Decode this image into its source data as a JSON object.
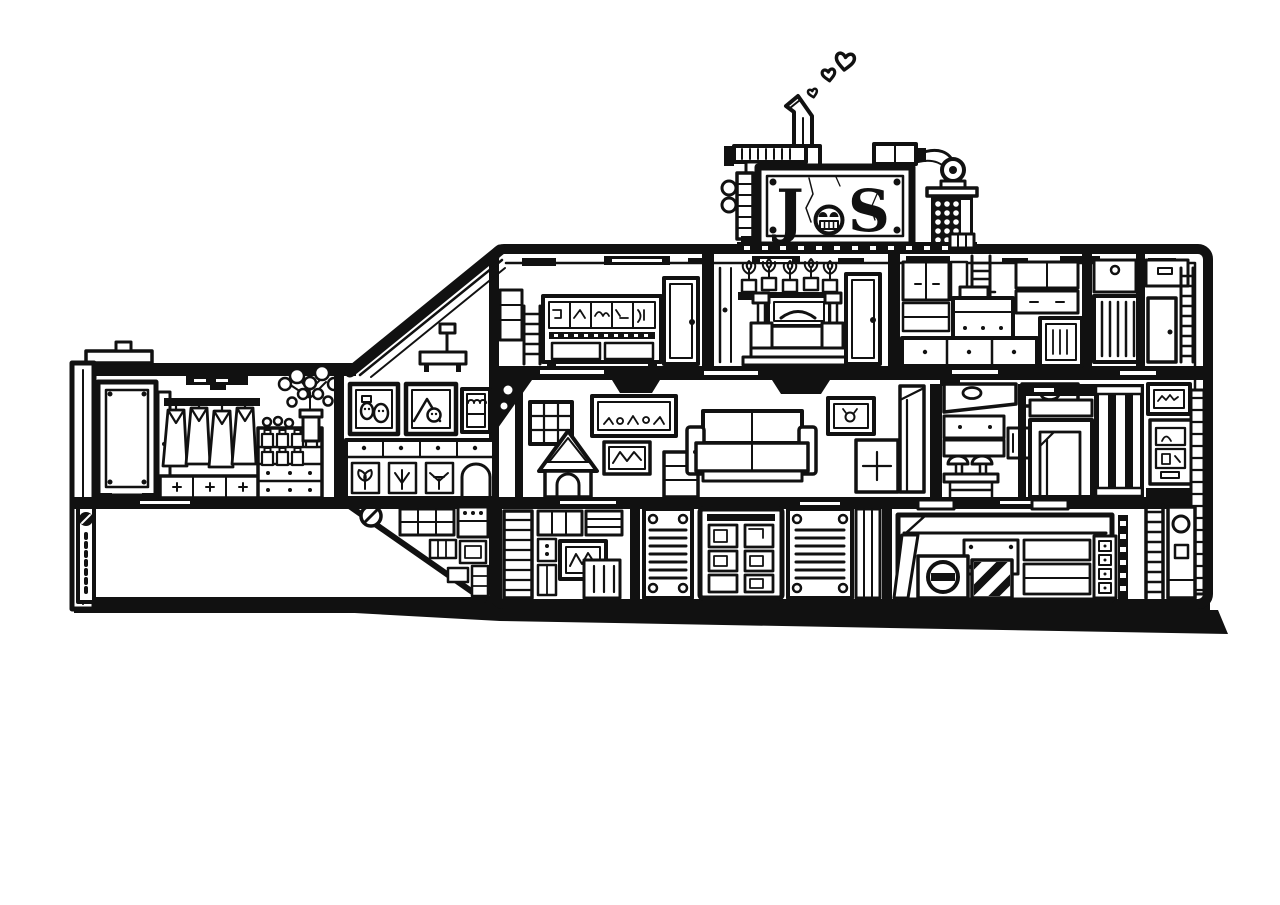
{
  "palette": {
    "ink": "#111111",
    "paper": "#ffffff"
  },
  "sign": {
    "letter_left": "J",
    "letter_right": "S"
  }
}
